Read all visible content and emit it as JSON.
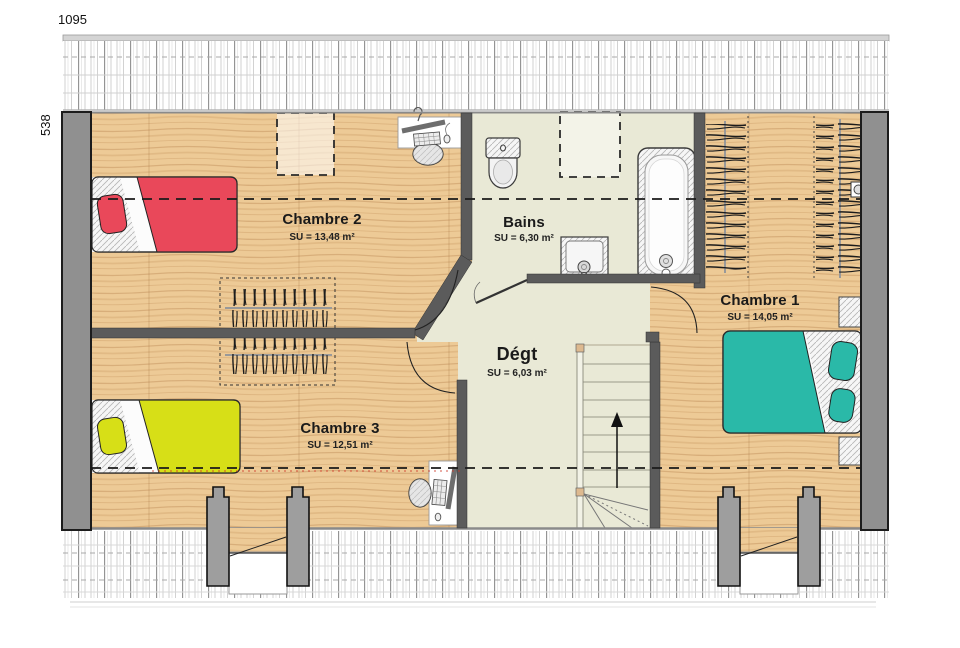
{
  "plan": {
    "width_label": "1095",
    "height_label": "538",
    "rooms": [
      {
        "id": "chambre2",
        "name": "Chambre 2",
        "surface": "SU = 13,48 m²"
      },
      {
        "id": "bains",
        "name": "Bains",
        "surface": "SU = 6,30 m²"
      },
      {
        "id": "chambre1",
        "name": "Chambre 1",
        "surface": "SU = 14,05 m²"
      },
      {
        "id": "chambre3",
        "name": "Chambre 3",
        "surface": "SU = 12,51 m²"
      },
      {
        "id": "degt",
        "name": "Dégt",
        "surface": "SU = 6,03 m²"
      }
    ],
    "colors": {
      "wood_floor": "#edca96",
      "soft_floor": "#e9e9d6",
      "wall_exterior": "#909090",
      "wall_interior": "#5b5b5b",
      "bed_red": "#e9485a",
      "bed_yellow": "#d7df17",
      "bed_teal": "#2ab9a8"
    },
    "stairs": {
      "direction": "up"
    },
    "symbols": [
      "single-bed",
      "double-bed",
      "bathtub",
      "toilet",
      "washbasin",
      "desk-computer",
      "office-chair",
      "stairs-up",
      "skylight",
      "wardrobe-hangers",
      "dormer-window",
      "wall-light",
      "door-swing",
      "roof-tiles"
    ]
  }
}
